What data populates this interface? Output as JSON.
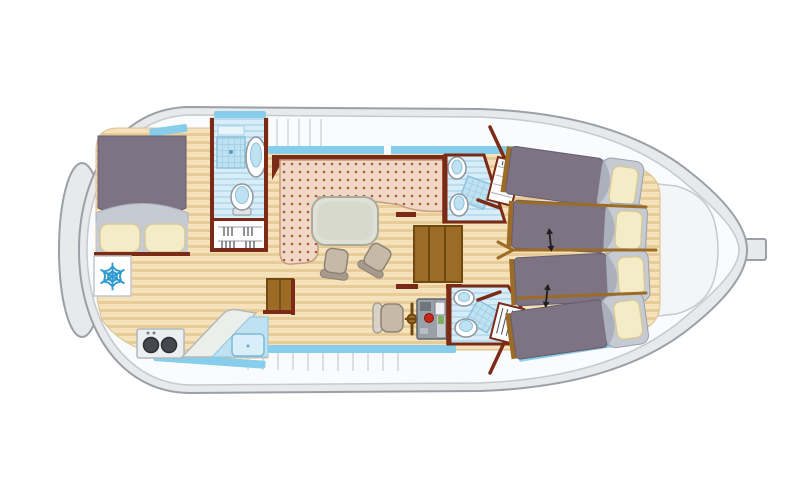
{
  "meta": {
    "description": "Top-view deck plan of a canal houseboat (penichette style floor plan), no visible text labels in image"
  },
  "colors": {
    "page_bg": "#ffffff",
    "hull": "#e8e9eb",
    "hull_stroke": "#9aa0a6",
    "deck": "#fafbfc",
    "deck_stroke": "#c6c9cd",
    "deck_line": "#dcdee1",
    "stern_deck": "#f4f5f6",
    "floor": "#f5e2ba",
    "floor_stripe": "#e7cc9a",
    "wall": "#7b2a15",
    "wood": "#9c6b26",
    "wood_dark": "#6e4a12",
    "window": "#87ceec",
    "bath": "#d9edf8",
    "bath_stripe": "#b9ddef",
    "bath_deep": "#bfe2f2",
    "shower_grid": "#8fc2de",
    "fixture": "#ffffff",
    "fixture_stroke": "#8e959c",
    "bed_blanket": "#7d7383",
    "bed_blanket_stroke": "#665d6e",
    "bed_head": "#c5cad3",
    "bed_head_shade": "#aab1bd",
    "pillow": "#f4ecc7",
    "pillow_stroke": "#d5c99b",
    "sofa": "#efd8c6",
    "sofa_dot": "#ad5a42",
    "sofa_stroke": "#c89b7e",
    "table": "#dfe1d6",
    "table_stroke": "#a9ab9b",
    "chair": "#c6b9a8",
    "chair_stroke": "#8f8376",
    "chair_back": "#d8d2c8",
    "stove_body": "#eceff0",
    "burner": "#45494f",
    "panel": "#9aa0a8",
    "panel_light": "#c9ced4",
    "panel_screen": "#eef0f2",
    "red_button": "#c8281a",
    "green_light": "#7fae5f",
    "snowflake": "#2f9ad0",
    "arrow": "#1f1f1f"
  },
  "legend": {
    "rooms": [
      "forward-cabin",
      "forward-bathroom",
      "saloon",
      "galley",
      "helm-station",
      "aft-bathroom-top",
      "aft-bathroom-bottom",
      "aft-cabin-top",
      "aft-cabin-bottom",
      "stern-deck",
      "bow-fender",
      "side-decks"
    ],
    "furniture": [
      {
        "name": "double-bed",
        "qty": 1
      },
      {
        "name": "single-bed",
        "qty": 4
      },
      {
        "name": "pillow",
        "qty": 6
      },
      {
        "name": "l-shaped-sofa",
        "qty": 1
      },
      {
        "name": "dining-table",
        "qty": 1
      },
      {
        "name": "dining-chair",
        "qty": 2
      },
      {
        "name": "helm-seat",
        "qty": 1
      },
      {
        "name": "steering-wheel",
        "qty": 1
      },
      {
        "name": "instrument-panel",
        "qty": 1
      },
      {
        "name": "companionway-steps",
        "qty": 1
      },
      {
        "name": "stove-two-burners",
        "qty": 1
      },
      {
        "name": "galley-counter",
        "qty": 1
      },
      {
        "name": "kitchen-sink",
        "qty": 1
      },
      {
        "name": "refrigerator",
        "qty": 1
      },
      {
        "name": "shower",
        "qty": 3
      },
      {
        "name": "toilet",
        "qty": 3
      },
      {
        "name": "washbasin",
        "qty": 3
      },
      {
        "name": "wardrobe",
        "qty": 4
      },
      {
        "name": "sliding-bed-arrow",
        "qty": 2
      }
    ],
    "icons": [
      {
        "name": "snowflake-icon",
        "meaning": "refrigerator"
      },
      {
        "name": "double-arrow-icon",
        "meaning": "beds slide together"
      }
    ]
  }
}
